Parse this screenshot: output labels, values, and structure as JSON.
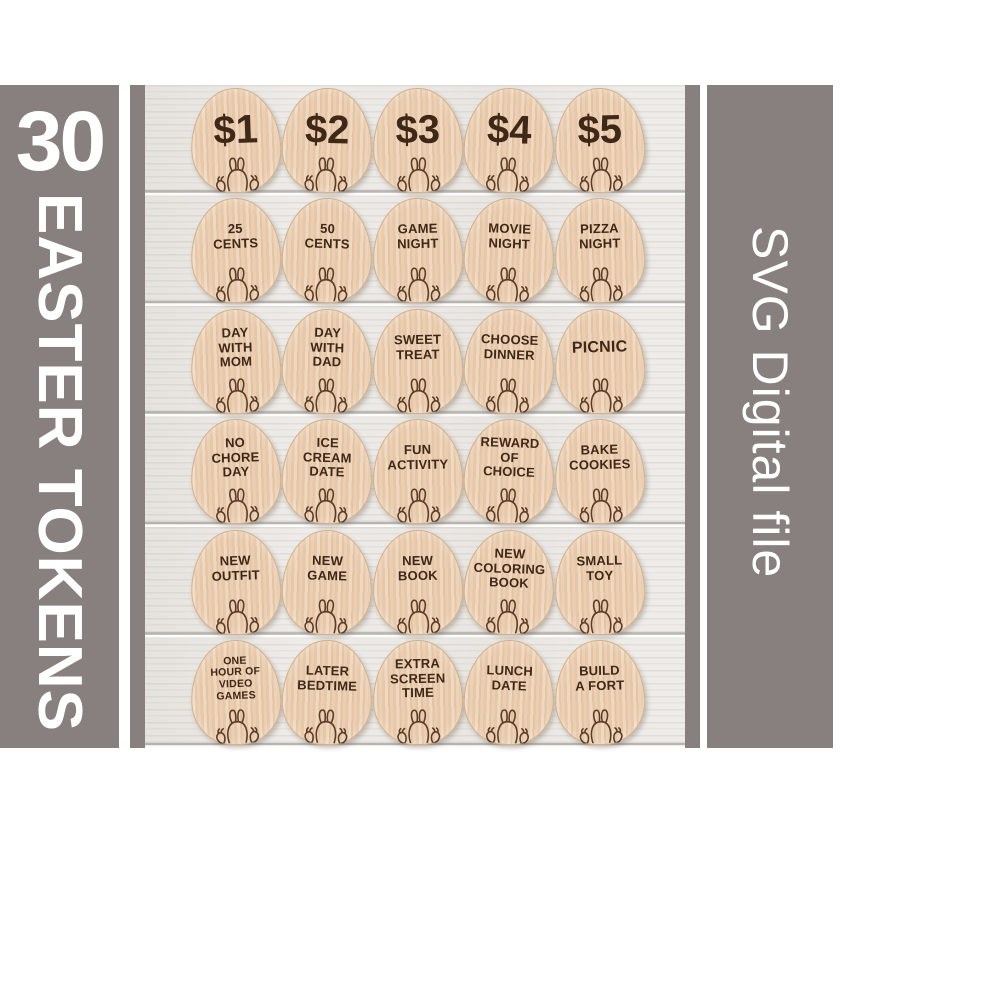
{
  "left_panel": {
    "count": "30",
    "title": "EASTER TOKENS"
  },
  "right_panel": {
    "label": "SVG Digital file"
  },
  "tokens": {
    "labels": [
      [
        "$1"
      ],
      [
        "$2"
      ],
      [
        "$3"
      ],
      [
        "$4"
      ],
      [
        "$5"
      ],
      [
        "25",
        "CENTS"
      ],
      [
        "50",
        "CENTS"
      ],
      [
        "GAME",
        "NIGHT"
      ],
      [
        "MOVIE",
        "NIGHT"
      ],
      [
        "PIZZA",
        "NIGHT"
      ],
      [
        "DAY",
        "WITH",
        "MOM"
      ],
      [
        "DAY",
        "WITH",
        "DAD"
      ],
      [
        "SWEET",
        "TREAT"
      ],
      [
        "CHOOSE",
        "DINNER"
      ],
      [
        "PICNIC"
      ],
      [
        "NO",
        "CHORE",
        "DAY"
      ],
      [
        "ICE",
        "CREAM",
        "DATE"
      ],
      [
        "FUN",
        "ACTIVITY"
      ],
      [
        "REWARD",
        "OF",
        "CHOICE"
      ],
      [
        "BAKE",
        "COOKIES"
      ],
      [
        "NEW",
        "OUTFIT"
      ],
      [
        "NEW",
        "GAME"
      ],
      [
        "NEW",
        "BOOK"
      ],
      [
        "NEW",
        "COLORING",
        "BOOK"
      ],
      [
        "SMALL",
        "TOY"
      ],
      [
        "ONE",
        "HOUR OF",
        "VIDEO",
        "GAMES"
      ],
      [
        "LATER",
        "BEDTIME"
      ],
      [
        "EXTRA",
        "SCREEN",
        "TIME"
      ],
      [
        "LUNCH",
        "DATE"
      ],
      [
        "BUILD",
        "A FORT"
      ]
    ]
  },
  "icons": {
    "bunny": "bunny-back-outline",
    "berries": "berry-outline-pair"
  },
  "colors": {
    "banner_gray": "#87807e",
    "banner_text": "#ffffff",
    "wood_background": "#eeece9",
    "egg_wood_light": "#f0d8c0",
    "egg_wood_dark": "#e3c3a4",
    "token_text_brown": "#3f2817",
    "bunny_stroke": "#5c3c26"
  }
}
